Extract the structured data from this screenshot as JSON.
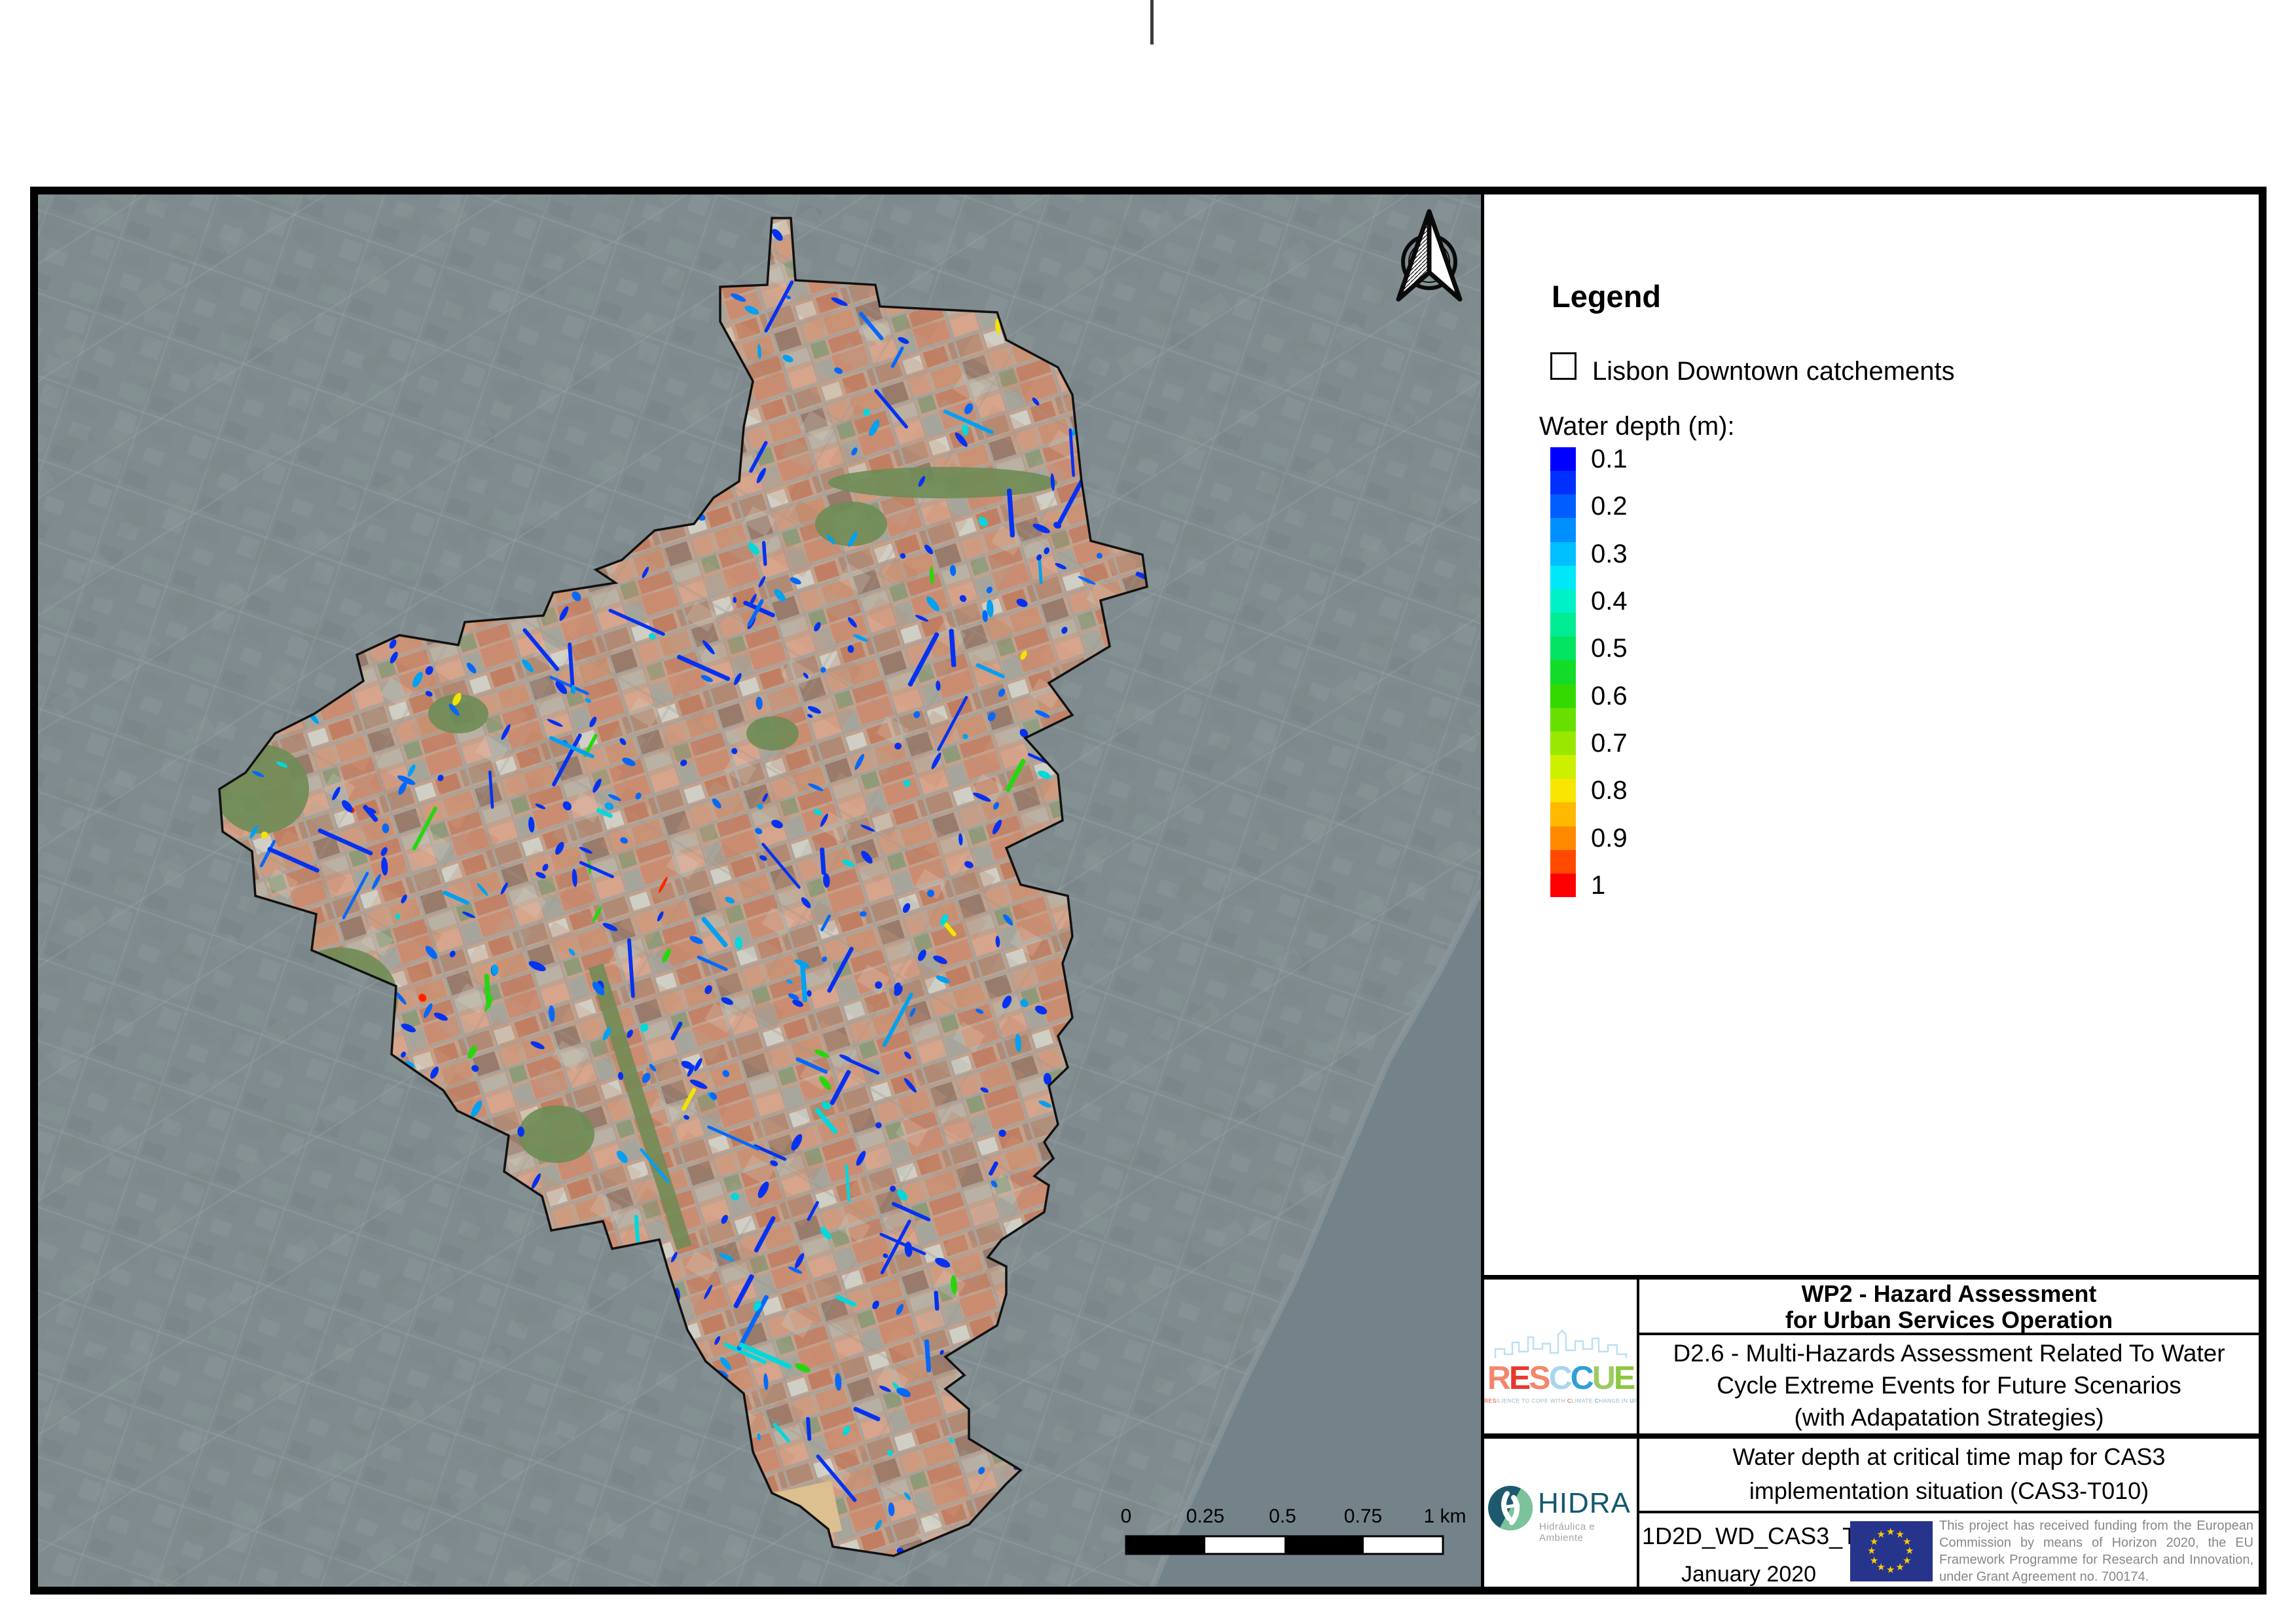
{
  "legend": {
    "title": "Legend",
    "catchment_item": {
      "label": "Lisbon Downtown catchements"
    },
    "water_depth": {
      "label": "Water depth (m):",
      "levels": [
        "0.1",
        "0.2",
        "0.3",
        "0.4",
        "0.5",
        "0.6",
        "0.7",
        "0.8",
        "0.9",
        "1"
      ],
      "ramp_colors": [
        "#0000FE",
        "#0030FF",
        "#005DFF",
        "#008FFF",
        "#00BFFF",
        "#00E8F8",
        "#00F0C8",
        "#00EC92",
        "#00E45F",
        "#12DC28",
        "#33D900",
        "#67E000",
        "#9AE800",
        "#CCEF00",
        "#F7E600",
        "#FFB900",
        "#FF8A00",
        "#FF4A00",
        "#FE0000"
      ]
    }
  },
  "map": {
    "scalebar": {
      "labels": [
        "0",
        "0.25",
        "0.5",
        "0.75",
        "1 km"
      ]
    }
  },
  "titleblock": {
    "wp2_line1": "WP2 - Hazard Assessment",
    "wp2_line2": "for Urban Services Operation",
    "d26_lines": [
      "D2.6 - Multi-Hazards Assessment Related To Water",
      "Cycle Extreme Events for Future Scenarios",
      "(with Adapatation Strategies)"
    ],
    "map_title_line1": "Water depth at critical time map for CAS3",
    "map_title_line2": "implementation situation (CAS3-T010)",
    "code": "1D2D_WD_CAS3_T010",
    "date": "January 2020",
    "funding_text": "This project has received funding from the European Commission by means of Horizon 2020, the EU Framework Programme for Research and Innovation, under Grant Agreement no. 700174."
  },
  "logos": {
    "resccue": {
      "letters": [
        {
          "ch": "R",
          "color": "#F2876B"
        },
        {
          "ch": "E",
          "color": "#E8382C"
        },
        {
          "ch": "S",
          "color": "#F2876B"
        },
        {
          "ch": "C",
          "color": "#A9D6EF"
        },
        {
          "ch": "C",
          "color": "#2F9FD8"
        },
        {
          "ch": "U",
          "color": "#9BCB63"
        },
        {
          "ch": "E",
          "color": "#8DC63F"
        }
      ],
      "tagline_segments": [
        {
          "text": "RES",
          "color": "#E8382C"
        },
        {
          "text": "ILIENCE TO COPE WITH ",
          "color": "#9FB6C3"
        },
        {
          "text": "C",
          "color": "#E8382C"
        },
        {
          "text": "LIMATE ",
          "color": "#9FB6C3"
        },
        {
          "text": "C",
          "color": "#2F9FD8"
        },
        {
          "text": "HANGE IN ",
          "color": "#9FB6C3"
        },
        {
          "text": "U",
          "color": "#2F9FD8"
        },
        {
          "text": "RBAN AR",
          "color": "#9FB6C3"
        },
        {
          "text": "E",
          "color": "#8DC63F"
        },
        {
          "text": "AS.",
          "color": "#9FB6C3"
        }
      ]
    },
    "hidra": {
      "name": "HIDRA",
      "subtitle": "Hidráulica e Ambiente",
      "name_color": "#15586E",
      "subtitle_color": "#A3A3A3"
    }
  },
  "colors": {
    "dimmed_city": "#7F8B8E",
    "river": "#74838A",
    "catchment_base": "#C3A28F",
    "catchment_boundary": "#111111",
    "eu_flag_blue": "#26348C",
    "eu_flag_star": "#FFCC00",
    "flood_blues": [
      "#0531F2",
      "#0668FB",
      "#00A0F2",
      "#00D8DC"
    ],
    "flood_rare": [
      "#27D60E",
      "#F2E400",
      "#FF2400"
    ]
  }
}
